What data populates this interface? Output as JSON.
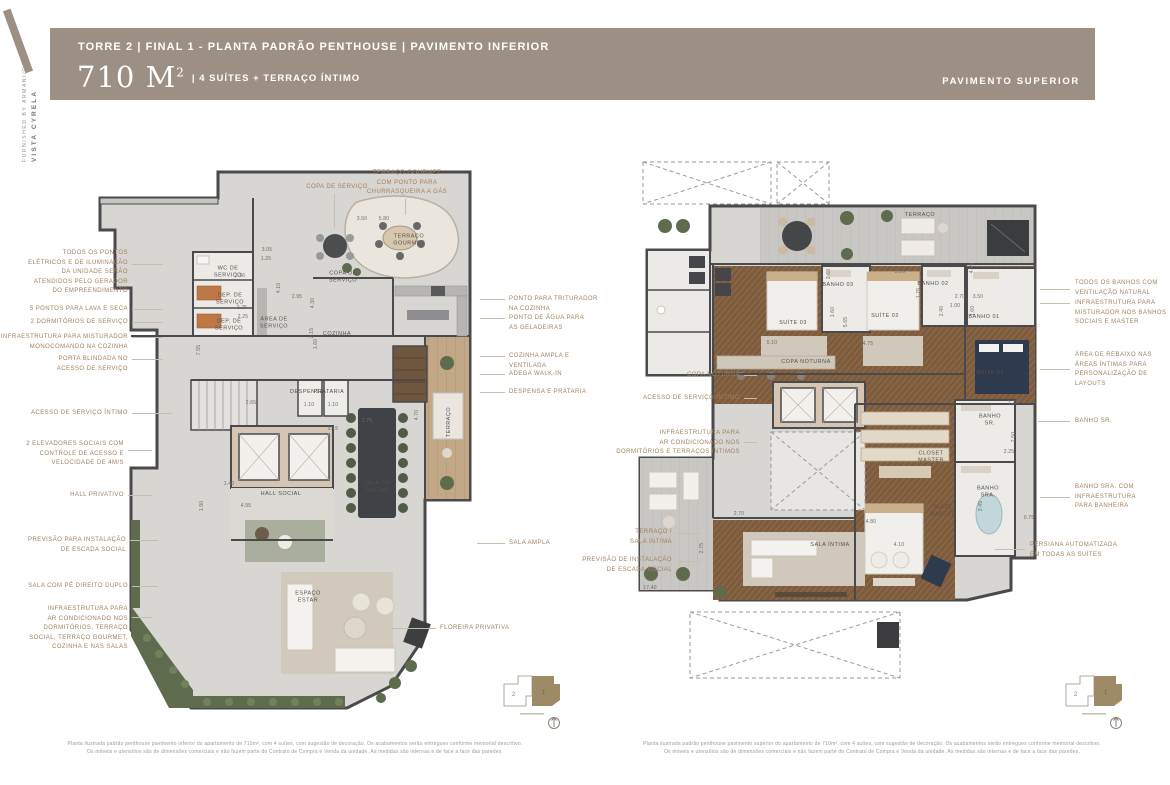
{
  "brand": {
    "line1": "VISTA CYRELA",
    "line2": "FURNISHED BY ARMANI/CASA"
  },
  "header": {
    "title": "TORRE 2 | FINAL 1 - PLANTA PADRÃO PENTHOUSE | PAVIMENTO INFERIOR",
    "area": "710 M",
    "area_exp": "2",
    "subtitle": "| 4 SUÍTES + TERRAÇO ÍNTIMO",
    "right_label": "PAVIMENTO SUPERIOR",
    "bg_color": "#9c9084",
    "callout_color": "#a1805f"
  },
  "keyplan": {
    "unit1": "1",
    "unit2": "2"
  },
  "plans": [
    {
      "id": "inferior",
      "rooms": [
        {
          "t": "WC DE\nSERVIÇO",
          "x": 228,
          "y": 272
        },
        {
          "t": "DEP. DE\nSERVIÇO",
          "x": 230,
          "y": 299
        },
        {
          "t": "DEP. DE\nSERVIÇO",
          "x": 229,
          "y": 325
        },
        {
          "t": "ÁREA DE\nSERVIÇO",
          "x": 274,
          "y": 323
        },
        {
          "t": "COPA DE\nSERVIÇO",
          "x": 343,
          "y": 277
        },
        {
          "t": "COZINHA",
          "x": 337,
          "y": 334
        },
        {
          "t": "TERRAÇO\nGOURMET",
          "x": 409,
          "y": 240
        },
        {
          "t": "DESPENSA",
          "x": 307,
          "y": 392
        },
        {
          "t": "PRATARIA",
          "x": 329,
          "y": 392
        },
        {
          "t": "HALL SOCIAL",
          "x": 281,
          "y": 494
        },
        {
          "t": "SALA DE\nJANTAR",
          "x": 377,
          "y": 487
        },
        {
          "t": "TERRAÇO",
          "x": 449,
          "y": 422,
          "r": 1
        },
        {
          "t": "ESPAÇO\nESTAR",
          "x": 308,
          "y": 597
        }
      ],
      "dims": [
        {
          "t": "3.05",
          "x": 267,
          "y": 250
        },
        {
          "t": "1.25",
          "x": 266,
          "y": 259
        },
        {
          "t": "3.50",
          "x": 362,
          "y": 219
        },
        {
          "t": "5.80",
          "x": 384,
          "y": 219
        },
        {
          "t": "2.36",
          "x": 240,
          "y": 276
        },
        {
          "t": "2.25",
          "x": 242,
          "y": 308
        },
        {
          "t": "2.25",
          "x": 243,
          "y": 317
        },
        {
          "t": "2.95",
          "x": 297,
          "y": 297
        },
        {
          "t": "4.10",
          "x": 279,
          "y": 288,
          "r": 1
        },
        {
          "t": "4.30",
          "x": 313,
          "y": 303,
          "r": 1
        },
        {
          "t": "7.55",
          "x": 199,
          "y": 350,
          "r": 1
        },
        {
          "t": "2.15",
          "x": 312,
          "y": 333,
          "r": 1
        },
        {
          "t": "1.60",
          "x": 316,
          "y": 344,
          "r": 1
        },
        {
          "t": "2.65",
          "x": 251,
          "y": 403
        },
        {
          "t": "1.10",
          "x": 309,
          "y": 405
        },
        {
          "t": "1.10",
          "x": 333,
          "y": 405
        },
        {
          "t": "1.40",
          "x": 229,
          "y": 484
        },
        {
          "t": "4.95",
          "x": 246,
          "y": 506
        },
        {
          "t": "1.90",
          "x": 202,
          "y": 506,
          "r": 1
        },
        {
          "t": "5.15",
          "x": 333,
          "y": 429
        },
        {
          "t": "1.75",
          "x": 367,
          "y": 421
        },
        {
          "t": "4.70",
          "x": 417,
          "y": 415,
          "r": 1
        }
      ],
      "callouts": [
        {
          "s": "L",
          "x": 128,
          "y": 249,
          "lines": [
            "TODOS OS PONTOS",
            "ELÉTRICOS E DE ILUMINAÇÃO",
            "DA UNIDADE SERÃO",
            "ATENDIDOS PELO GERADOR",
            "DO EMPREENDIMENTO"
          ],
          "line": [
            132,
            264,
            163,
            264
          ]
        },
        {
          "s": "L",
          "x": 128,
          "y": 305,
          "lines": [
            "5 PONTOS PARA LAVA E SECA"
          ],
          "line": [
            132,
            309,
            163,
            309
          ]
        },
        {
          "s": "L",
          "x": 128,
          "y": 318,
          "lines": [
            "2 DORMITÓRIOS DE SERVIÇO"
          ],
          "line": [
            132,
            322,
            163,
            322
          ]
        },
        {
          "s": "L",
          "x": 128,
          "y": 333,
          "lines": [
            "INFRAESTRUTURA PARA MISTURADOR",
            "MONOCOMANDO NA COZINHA"
          ],
          "line": [
            132,
            337,
            163,
            337
          ]
        },
        {
          "s": "L",
          "x": 128,
          "y": 355,
          "lines": [
            "PORTA BLINDADA NO",
            "ACESSO DE SERVIÇO"
          ],
          "line": [
            132,
            359,
            163,
            359
          ]
        },
        {
          "s": "L",
          "x": 128,
          "y": 409,
          "lines": [
            "ACESSO DE SERVIÇO ÍNTIMO"
          ],
          "line": [
            132,
            413,
            172,
            413
          ]
        },
        {
          "s": "L",
          "x": 124,
          "y": 440,
          "lines": [
            "2 ELEVADORES SOCIAIS COM",
            "CONTROLE DE ACESSO E",
            "VELOCIDADE DE 4M/S"
          ],
          "line": [
            128,
            450,
            152,
            450
          ]
        },
        {
          "s": "L",
          "x": 124,
          "y": 491,
          "lines": [
            "HALL PRIVATIVO"
          ],
          "line": [
            128,
            495,
            152,
            495
          ]
        },
        {
          "s": "L",
          "x": 126,
          "y": 536,
          "lines": [
            "PREVISÃO PARA INSTALAÇÃO",
            "DE ESCADA SOCIAL"
          ],
          "line": [
            130,
            540,
            158,
            540
          ]
        },
        {
          "s": "L",
          "x": 128,
          "y": 582,
          "lines": [
            "SALA COM PÉ DIREITO DUPLO"
          ],
          "line": [
            132,
            586,
            158,
            586
          ]
        },
        {
          "s": "L",
          "x": 128,
          "y": 605,
          "lines": [
            "INFRAESTRUTURA PARA",
            "AR CONDICIONADO NOS",
            "DORMITÓRIOS, TERRAÇO",
            "SOCIAL, TERRAÇO GOURMET,",
            "COZINHA E NAS SALAS"
          ],
          "line": [
            132,
            617,
            152,
            617
          ]
        },
        {
          "s": "T",
          "x": 337,
          "y": 183,
          "lines": [
            "COPA DE SERVIÇO"
          ],
          "line": [
            334,
            194,
            334,
            228
          ]
        },
        {
          "s": "T",
          "x": 407,
          "y": 169,
          "lines": [
            "TERRAÇO GOURMET",
            "COM PONTO PARA",
            "CHURRASQUEIRA A GÁS"
          ],
          "line": [
            405,
            199,
            405,
            215
          ]
        },
        {
          "s": "R",
          "x": 509,
          "y": 295,
          "lines": [
            "PONTO PARA TRITURADOR",
            "NA COZINHA"
          ],
          "line": [
            480,
            299,
            505,
            299
          ]
        },
        {
          "s": "R",
          "x": 509,
          "y": 314,
          "lines": [
            "PONTO DE ÁGUA PARA",
            "AS GELADEIRAS"
          ],
          "line": [
            480,
            318,
            505,
            318
          ]
        },
        {
          "s": "R",
          "x": 509,
          "y": 352,
          "lines": [
            "COZINHA AMPLA E",
            "VENTILADA"
          ],
          "line": [
            480,
            356,
            505,
            356
          ]
        },
        {
          "s": "R",
          "x": 509,
          "y": 370,
          "lines": [
            "ADEGA WALK-IN"
          ],
          "line": [
            480,
            374,
            505,
            374
          ]
        },
        {
          "s": "R",
          "x": 509,
          "y": 388,
          "lines": [
            "DESPENSA E PRATARIA"
          ],
          "line": [
            480,
            392,
            505,
            392
          ]
        },
        {
          "s": "R",
          "x": 509,
          "y": 539,
          "lines": [
            "SALA AMPLA"
          ],
          "line": [
            477,
            543,
            505,
            543
          ]
        },
        {
          "s": "R",
          "x": 440,
          "y": 624,
          "lines": [
            "FLOREIRA PRIVATIVA"
          ],
          "line": [
            392,
            628,
            436,
            628
          ]
        }
      ],
      "disclaimer": [
        "Planta ilustrada padrão penthouse pavimento inferior do apartamento de 710m², com 4 suítes, com sugestão de decoração. Os acabamentos serão entregues conforme memorial descritivo.",
        "Os móveis e utensílios são de dimensões comerciais e não fazem parte do Contrato de Compra e Venda da unidade. As medidas são internas e de face a face das paredes."
      ]
    },
    {
      "id": "superior",
      "rooms": [
        {
          "t": "TERRAÇO",
          "x": 920,
          "y": 215
        },
        {
          "t": "SUÍTE 03",
          "x": 793,
          "y": 323
        },
        {
          "t": "BANHO 03",
          "x": 838,
          "y": 285
        },
        {
          "t": "SUÍTE 02",
          "x": 885,
          "y": 316
        },
        {
          "t": "BANHO 02",
          "x": 933,
          "y": 284
        },
        {
          "t": "BANHO 01",
          "x": 984,
          "y": 317
        },
        {
          "t": "SUÍTE 01",
          "x": 990,
          "y": 373
        },
        {
          "t": "COPA NOTURNA",
          "x": 806,
          "y": 362
        },
        {
          "t": "CLOSET\nMASTER",
          "x": 931,
          "y": 457
        },
        {
          "t": "SUÍTE\nMASTER",
          "x": 943,
          "y": 511
        },
        {
          "t": "BANHO\nSR.",
          "x": 990,
          "y": 420
        },
        {
          "t": "BANHO\nSRA.",
          "x": 988,
          "y": 492
        },
        {
          "t": "SALA ÍNTIMA",
          "x": 830,
          "y": 545
        }
      ],
      "dims": [
        {
          "t": "5.10",
          "x": 772,
          "y": 343
        },
        {
          "t": "3.20",
          "x": 802,
          "y": 270
        },
        {
          "t": "2.60",
          "x": 829,
          "y": 274,
          "r": 1
        },
        {
          "t": "3.90",
          "x": 900,
          "y": 272
        },
        {
          "t": "2.70",
          "x": 960,
          "y": 297
        },
        {
          "t": "3.50",
          "x": 978,
          "y": 297
        },
        {
          "t": "1.60",
          "x": 833,
          "y": 312,
          "r": 1
        },
        {
          "t": "1.75",
          "x": 919,
          "y": 293,
          "r": 1
        },
        {
          "t": "1.00",
          "x": 955,
          "y": 306
        },
        {
          "t": "2.40",
          "x": 942,
          "y": 311,
          "r": 1
        },
        {
          "t": "1.60",
          "x": 973,
          "y": 311,
          "r": 1
        },
        {
          "t": "2.55",
          "x": 1011,
          "y": 330
        },
        {
          "t": "4.75",
          "x": 868,
          "y": 344
        },
        {
          "t": "5.65",
          "x": 846,
          "y": 322,
          "r": 1
        },
        {
          "t": "4.75",
          "x": 972,
          "y": 268,
          "r": 1
        },
        {
          "t": "4.80",
          "x": 871,
          "y": 522
        },
        {
          "t": "2.25",
          "x": 1013,
          "y": 403
        },
        {
          "t": "2.50",
          "x": 1014,
          "y": 437,
          "r": 1
        },
        {
          "t": "2.25",
          "x": 1009,
          "y": 452
        },
        {
          "t": "0.75",
          "x": 1029,
          "y": 518
        },
        {
          "t": "3.45",
          "x": 981,
          "y": 506,
          "r": 1
        },
        {
          "t": "2.70",
          "x": 739,
          "y": 514
        },
        {
          "t": "2.75",
          "x": 702,
          "y": 548,
          "r": 1
        },
        {
          "t": "4.10",
          "x": 899,
          "y": 545
        },
        {
          "t": "17.40",
          "x": 650,
          "y": 588
        }
      ],
      "callouts": [
        {
          "s": "L",
          "x": 740,
          "y": 371,
          "lines": [
            "COPA NOTURNA"
          ],
          "line": [
            744,
            375,
            757,
            375
          ]
        },
        {
          "s": "L",
          "x": 740,
          "y": 394,
          "lines": [
            "ACESSO DE SERVIÇO ÍNTIMO"
          ],
          "line": [
            744,
            398,
            757,
            398
          ]
        },
        {
          "s": "L",
          "x": 740,
          "y": 429,
          "lines": [
            "INFRAESTRUTURA PARA",
            "AR CONDICIONADO NOS",
            "DORMITÓRIOS E TERRAÇOS ÍNTIMOS"
          ],
          "line": [
            744,
            442,
            757,
            442
          ]
        },
        {
          "s": "L",
          "x": 672,
          "y": 528,
          "lines": [
            "TERRAÇO /",
            "SALA ÍNTIMA"
          ],
          "line": [
            676,
            533,
            700,
            533
          ]
        },
        {
          "s": "L",
          "x": 672,
          "y": 556,
          "lines": [
            "PREVISÃO DE INSTALAÇÃO",
            "DE ESCADA SOCIAL"
          ],
          "line": [
            676,
            561,
            700,
            561
          ]
        },
        {
          "s": "R",
          "x": 1075,
          "y": 279,
          "lines": [
            "TODOS OS BANHOS COM",
            "VENTILAÇÃO NATURAL"
          ],
          "line": [
            1040,
            289,
            1070,
            289
          ]
        },
        {
          "s": "R",
          "x": 1075,
          "y": 299,
          "lines": [
            "INFRAESTRUTURA PARA",
            "MISTURADOR NOS BANHOS",
            "SOCIAIS E MASTER"
          ],
          "line": [
            1040,
            303,
            1070,
            303
          ]
        },
        {
          "s": "R",
          "x": 1075,
          "y": 351,
          "lines": [
            "ÁREA DE REBAIXO NAS",
            "ÁREAS ÍNTIMAS PARA",
            "PERSONALIZAÇÃO DE",
            "LAYOUTS"
          ],
          "line": [
            1040,
            369,
            1070,
            369
          ]
        },
        {
          "s": "R",
          "x": 1075,
          "y": 417,
          "lines": [
            "BANHO SR."
          ],
          "line": [
            1038,
            421,
            1070,
            421
          ]
        },
        {
          "s": "R",
          "x": 1075,
          "y": 483,
          "lines": [
            "BANHO SRA. COM",
            "INFRAESTRUTURA",
            "PARA BANHEIRA"
          ],
          "line": [
            1040,
            497,
            1070,
            497
          ]
        },
        {
          "s": "R",
          "x": 1030,
          "y": 541,
          "lines": [
            "PERSIANA AUTOMATIZADA",
            "EM TODAS AS SUÍTES"
          ],
          "line": [
            995,
            549,
            1025,
            549
          ]
        }
      ],
      "disclaimer": [
        "Planta ilustrada padrão penthouse pavimento superior do apartamento de 710m², com 4 suítes, com sugestão de decoração. Os acabamentos serão entregues conforme memorial descritivo.",
        "Os móveis e utensílios são de dimensões comerciais e não fazem parte do Contrato de Compra e Venda da unidade. As medidas são internas e de face a face das paredes."
      ]
    }
  ]
}
